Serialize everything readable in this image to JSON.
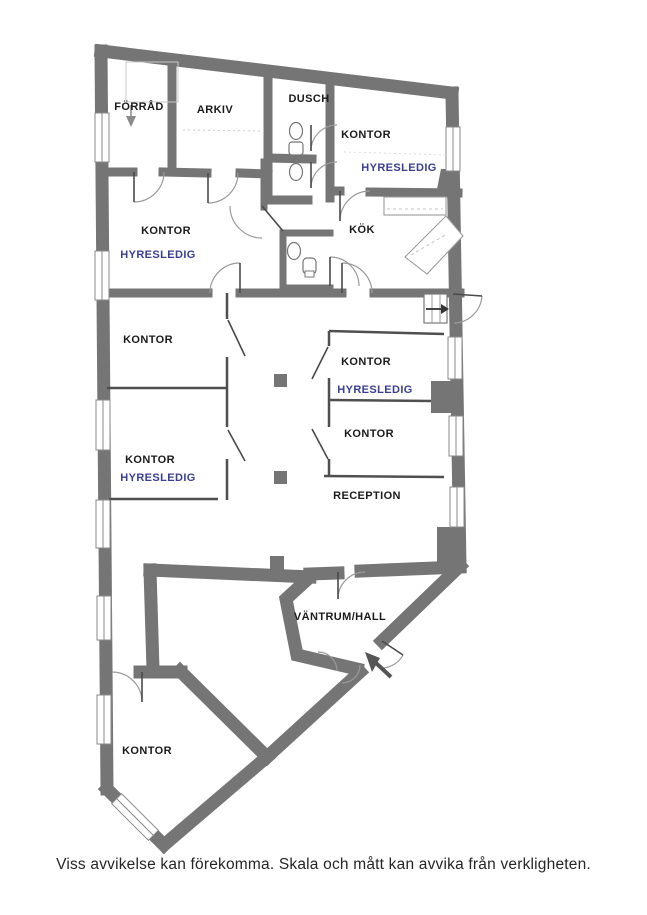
{
  "plan_type": "floor-plan",
  "colors": {
    "wall": "#757575",
    "thin_wall": "#4f4f4f",
    "vacant_text": "#3a3f94",
    "room_text": "#1b1b1b",
    "background": "#ffffff"
  },
  "rooms": {
    "forrad": {
      "label": "FÖRRÅD"
    },
    "arkiv": {
      "label": "ARKIV"
    },
    "dusch": {
      "label": "DUSCH"
    },
    "kontor_ne": {
      "label": "KONTOR",
      "status": "HYRESLEDIG"
    },
    "kontor_nw": {
      "label": "KONTOR",
      "status": "HYRESLEDIG"
    },
    "kok": {
      "label": "KÖK"
    },
    "kontor_w1": {
      "label": "KONTOR"
    },
    "kontor_e1": {
      "label": "KONTOR",
      "status": "HYRESLEDIG"
    },
    "kontor_e2": {
      "label": "KONTOR"
    },
    "kontor_w2": {
      "label": "KONTOR",
      "status": "HYRESLEDIG"
    },
    "reception": {
      "label": "RECEPTION"
    },
    "vantrum": {
      "label": "VÄNTRUM/HALL"
    },
    "kontor_s": {
      "label": "KONTOR"
    }
  },
  "footer": {
    "disclaimer": "Viss avvikelse kan förekomma. Skala och mått kan avvika från verkligheten."
  }
}
